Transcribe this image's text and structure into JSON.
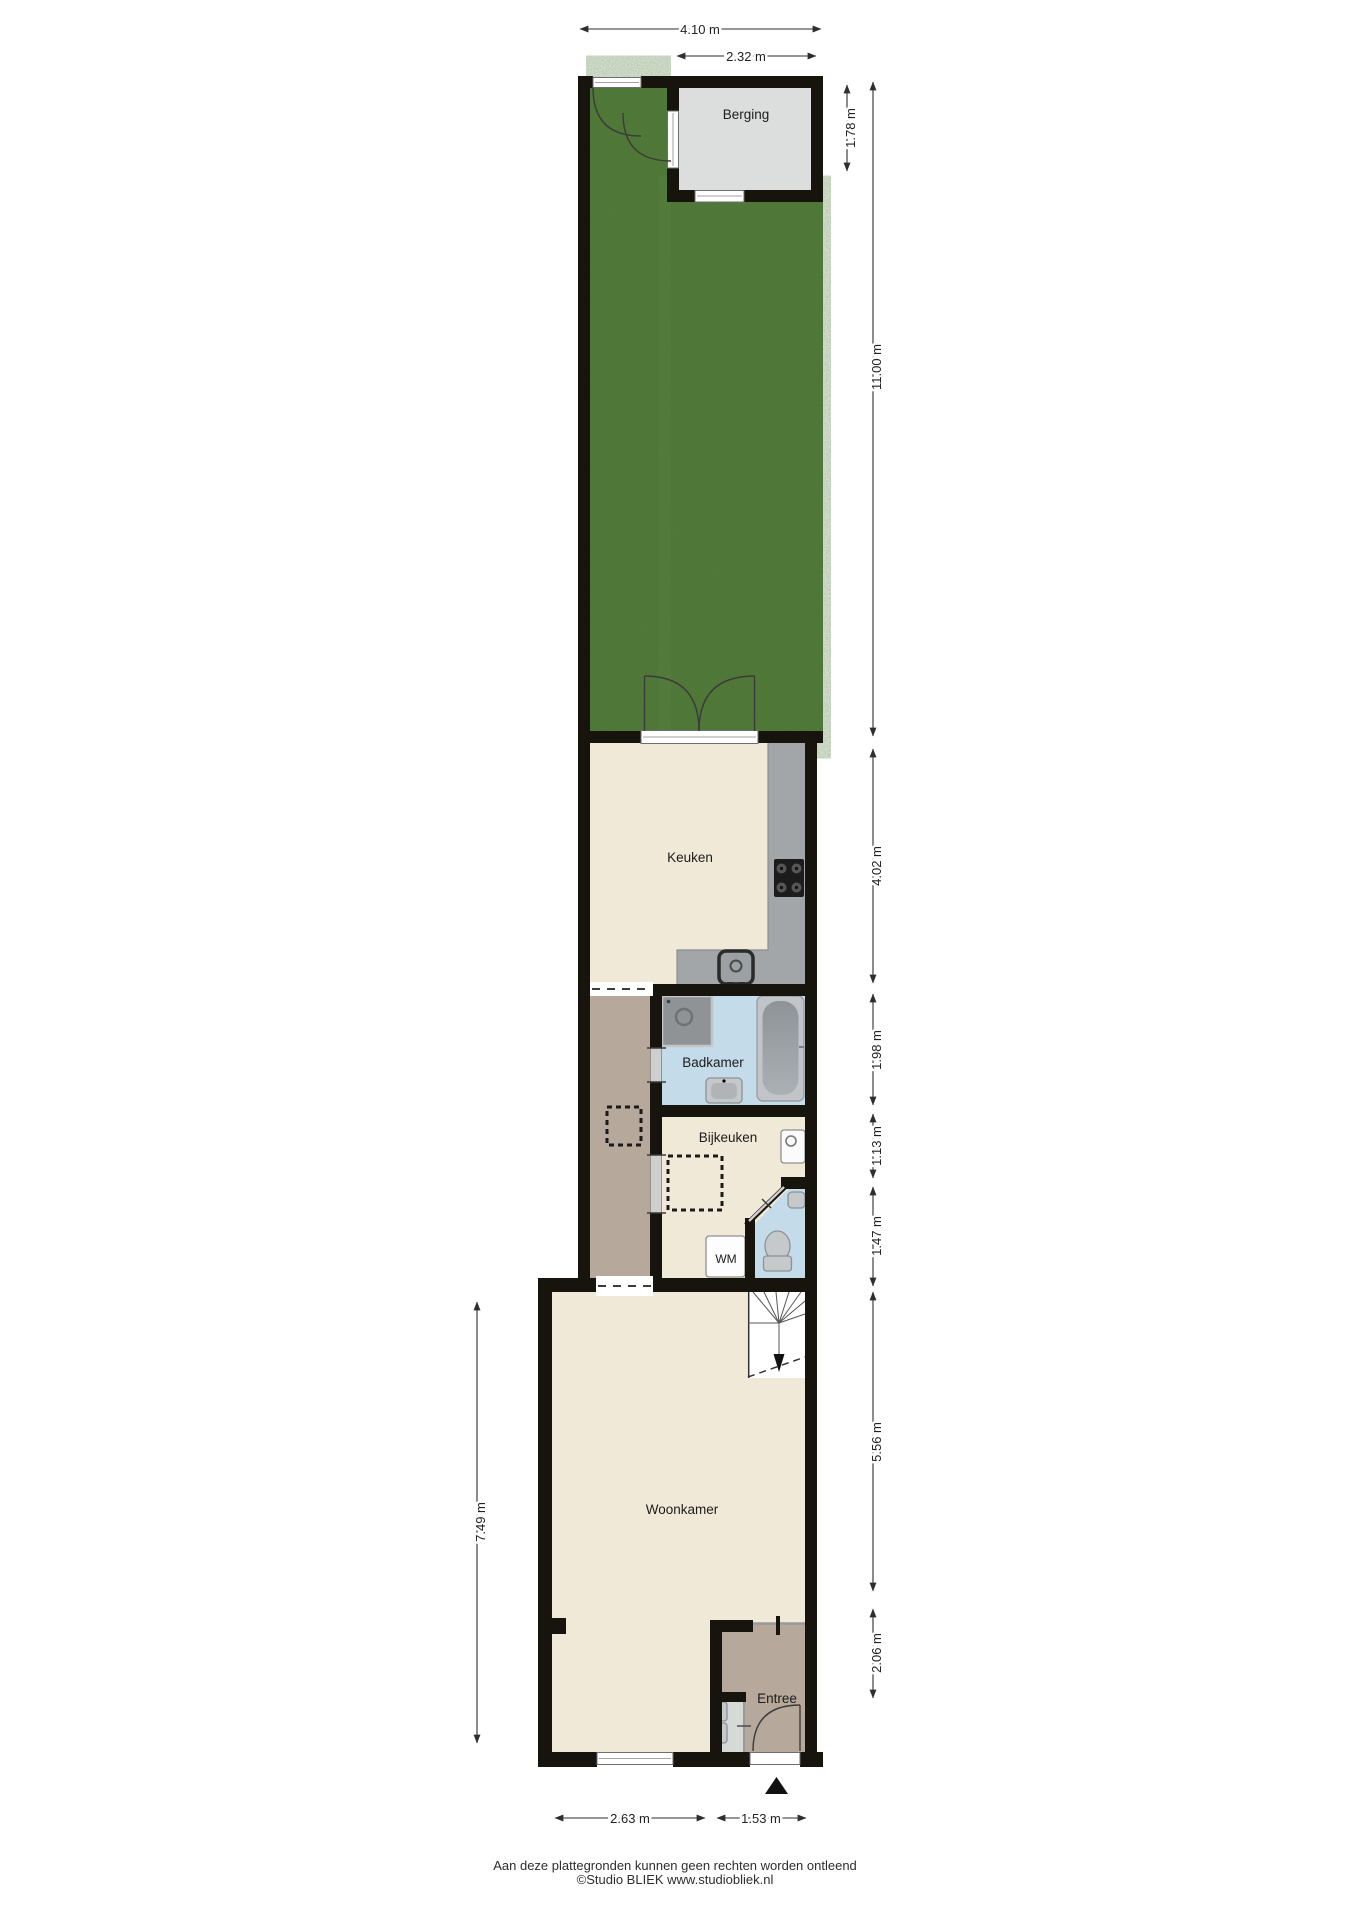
{
  "rooms": {
    "berging": "Berging",
    "keuken": "Keuken",
    "badkamer": "Badkamer",
    "bijkeuken": "Bijkeuken",
    "wm": "WM",
    "woonkamer": "Woonkamer",
    "entree": "Entree"
  },
  "dims": {
    "top_total": "4.10 m",
    "berging_width": "2.32 m",
    "berging_depth": "1.78 m",
    "garden_depth": "11.00 m",
    "keuken_depth": "4.02 m",
    "badkamer_depth": "1.98 m",
    "bijkeuken_depth": "1.13 m",
    "hal_depth": "1.47 m",
    "woonkamer_depth": "5.56 m",
    "entree_depth": "2.06 m",
    "woonkamer_width": "2.63 m",
    "entree_width": "1.53 m",
    "left_total": "7.49 m"
  },
  "footer": {
    "disclaimer": "Aan deze plattegronden kunnen geen rechten worden ontleend",
    "credit": "©Studio BLIEK www.studiobliek.nl"
  },
  "icons": {
    "north_indicator": "▲"
  },
  "colors": {
    "wall": "#17130d",
    "garden": "#4b7331",
    "room_floor": "#f1e9d7",
    "hall_floor": "#b6a89a",
    "wet_room": "#c4dcea",
    "berging_floor": "#dcdedd",
    "counter": "#a2a6a9",
    "fixture": "#c6c9cb",
    "stairs": "#ffffff"
  }
}
